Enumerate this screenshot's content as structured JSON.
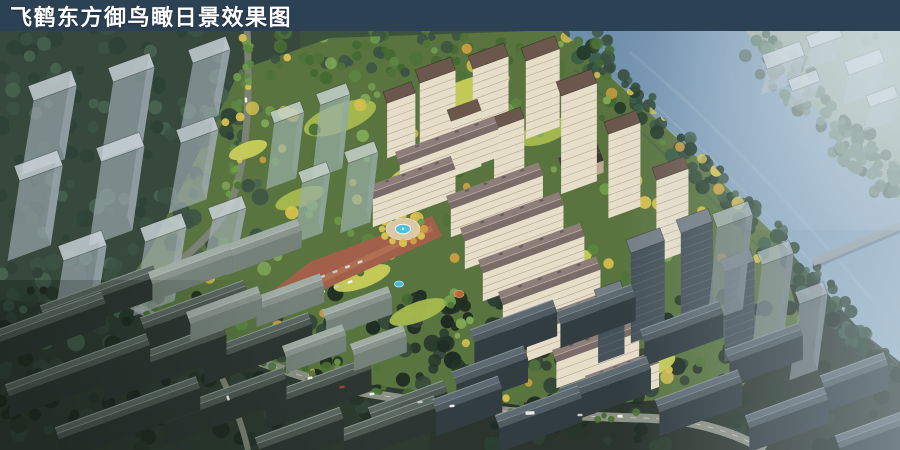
{
  "header": {
    "title": "飞鹤东方御鸟瞰日景效果图"
  },
  "scene": {
    "type": "architectural-aerial-rendering",
    "description": "Bird's-eye daytime rendering of the Feihe Dongfang Yu residential development: cream mid-rise rows and towers with brown roofs around a central fountain plaza, translucent future-phase massing blocks to the west and northeast, a river along the northeast edge, dark existing low-rise context to the south.",
    "regions": [
      {
        "id": "ghost-massing-west",
        "label": "translucent future-phase massing blocks over forest"
      },
      {
        "id": "river",
        "label": "river running diagonally along northeast edge"
      },
      {
        "id": "far-bank-forest",
        "label": "tree belt on far river bank"
      },
      {
        "id": "ghost-massing-northeast",
        "label": "hazy white massing blocks beyond river"
      },
      {
        "id": "site-buildings",
        "label": "cream residential towers and mid-rise rows with brown roofs"
      },
      {
        "id": "central-plaza",
        "label": "red-paved boulevard, circular fountain plaza, autumn trees, parked cars"
      },
      {
        "id": "context-lowrise-southwest",
        "label": "existing dark low-rise slabs in forest"
      },
      {
        "id": "context-highrise-southeast",
        "label": "dark high-rise and slab context along river, in shadow"
      },
      {
        "id": "roads",
        "label": "tree-lined boundary roads with traffic"
      }
    ],
    "palette": {
      "titleBar": "#2c4154",
      "titleText": "#ffffff",
      "baseGround": "#3c523c",
      "leftGround": "#36493c",
      "ctxGroundSW": "#2d3b31",
      "ctxGroundSE": "#2b352e",
      "siteGround": "#5a7440",
      "lawnA": "#a6bb4e",
      "lawnB": "#c9cd58",
      "river": "#6b8cab",
      "riverFar": "#9db6ca",
      "farFields": "#9aaa9c",
      "farBankA": "#5a7263",
      "farBankB": "#49604f",
      "farBankC": "#6a8371",
      "bankA": "#324c3a",
      "bankB": "#263c2c",
      "treeLeftA": "#3b5244",
      "treeLeftB": "#2e4237",
      "treeLeftC": "#486350",
      "treeDarkA": "#26352a",
      "treeDarkB": "#1f2c22",
      "treeDarkC": "#33453a",
      "siteTreeA": "#4f7239",
      "siteTreeB": "#5d8742",
      "siteTreeC": "#6f9a4b",
      "siteTreeD": "#446831",
      "siteTreeE": "#7fa855",
      "siteTreeY": "#d6c04e",
      "siteTreeO": "#cf9f3e",
      "roadA": "#7a8374",
      "roadB": "#8d9287",
      "roadLine": "#ffffff",
      "creamFront": "#e7deca",
      "creamSide": "#bcad96",
      "roofBrown": "#6b574c",
      "roofMauve": "#8e7e7a",
      "ridgeLight": "#c9bcae",
      "paleRoof": "#9fada4",
      "paleFront": "#74827a",
      "paleSide": "#5f6d66",
      "darkFront": "#46525a",
      "darkSide": "#39434b",
      "ctxRoofSW": "#5b6862",
      "ctxFaceSW": "#2c3733",
      "ctxEdge": "#93a09a",
      "ctxRoofSE": "#5e6a72",
      "ctxFaceSE": "#323d42",
      "ghostTop": "rgba(208,216,222,0.8)",
      "ghostFront": "rgba(170,182,190,0.6)",
      "ghostSide": "rgba(140,153,162,0.55)",
      "glassTop": "rgba(196,210,203,0.85)",
      "glassFront": "rgba(152,175,167,0.7)",
      "glassSide": "rgba(122,147,139,0.65)",
      "ghostDarkTop": "rgba(175,186,190,0.75)",
      "ghostDarkFront": "rgba(128,140,146,0.7)",
      "ghostDarkSide": "rgba(105,117,124,0.7)",
      "paving": "#a2604a",
      "pavingLight": "#bd7e5c",
      "plazaRing": "#d9c9a4",
      "fountain": "#4cc2e4",
      "pool": "#49b8dc",
      "playground": "#c96a3a",
      "carWhite": "#f2f2f2",
      "carGray": "#c9c9c9",
      "carRed": "#b5392e",
      "carDark": "#3c3c3c",
      "haze": "#c7d6e0",
      "bridge": "#9aa3a8"
    }
  }
}
